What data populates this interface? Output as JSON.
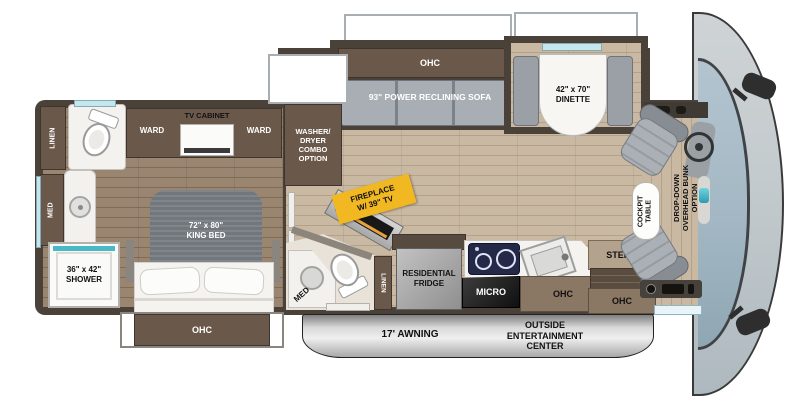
{
  "labels": {
    "rear_linen": "LINEN",
    "rear_med": "MED",
    "shower": "36\" x 42\"\nSHOWER",
    "ward_left": "WARD",
    "tv_cabinet": "TV CABINET",
    "ward_right": "WARD",
    "king_bed": "72\" x 80\"\nKING BED",
    "bed_ohc": "OHC",
    "washer_dryer": "WASHER/\nDRYER\nCOMBO\nOPTION",
    "sofa_ohc": "OHC",
    "sofa": "93\" POWER RECLINING SOFA",
    "dinette": "42\" x 70\"\nDINETTE",
    "fireplace": "FIREPLACE\nW/ 39\" TV",
    "mid_med": "MED",
    "mid_linen": "LINEN",
    "fridge": "RESIDENTIAL\nFRIDGE",
    "micro": "MICRO",
    "galley_ohc": "OHC",
    "steps": "STEPS",
    "entry_ohc": "OHC",
    "awning": "17' AWNING",
    "outside_ent": "OUTSIDE\nENTERTAINMENT\nCENTER",
    "cockpit_table": "COCKPIT\nTABLE",
    "drop_down_bunk": "DROP-DOWN\nOVERHEAD BUNK\nOPTION"
  },
  "colors": {
    "wall": "#4a4138",
    "cabinet": "#6a594a",
    "floor_living": "#c9b8a2",
    "floor_bedroom": "#9a8570",
    "furniture_gray": "#a8aeb3",
    "accent_teal": "#49b8c8",
    "fireplace_label": "#f2b822",
    "awning_silver": "#c4c4c4",
    "windshield": "#a9bdc9"
  }
}
